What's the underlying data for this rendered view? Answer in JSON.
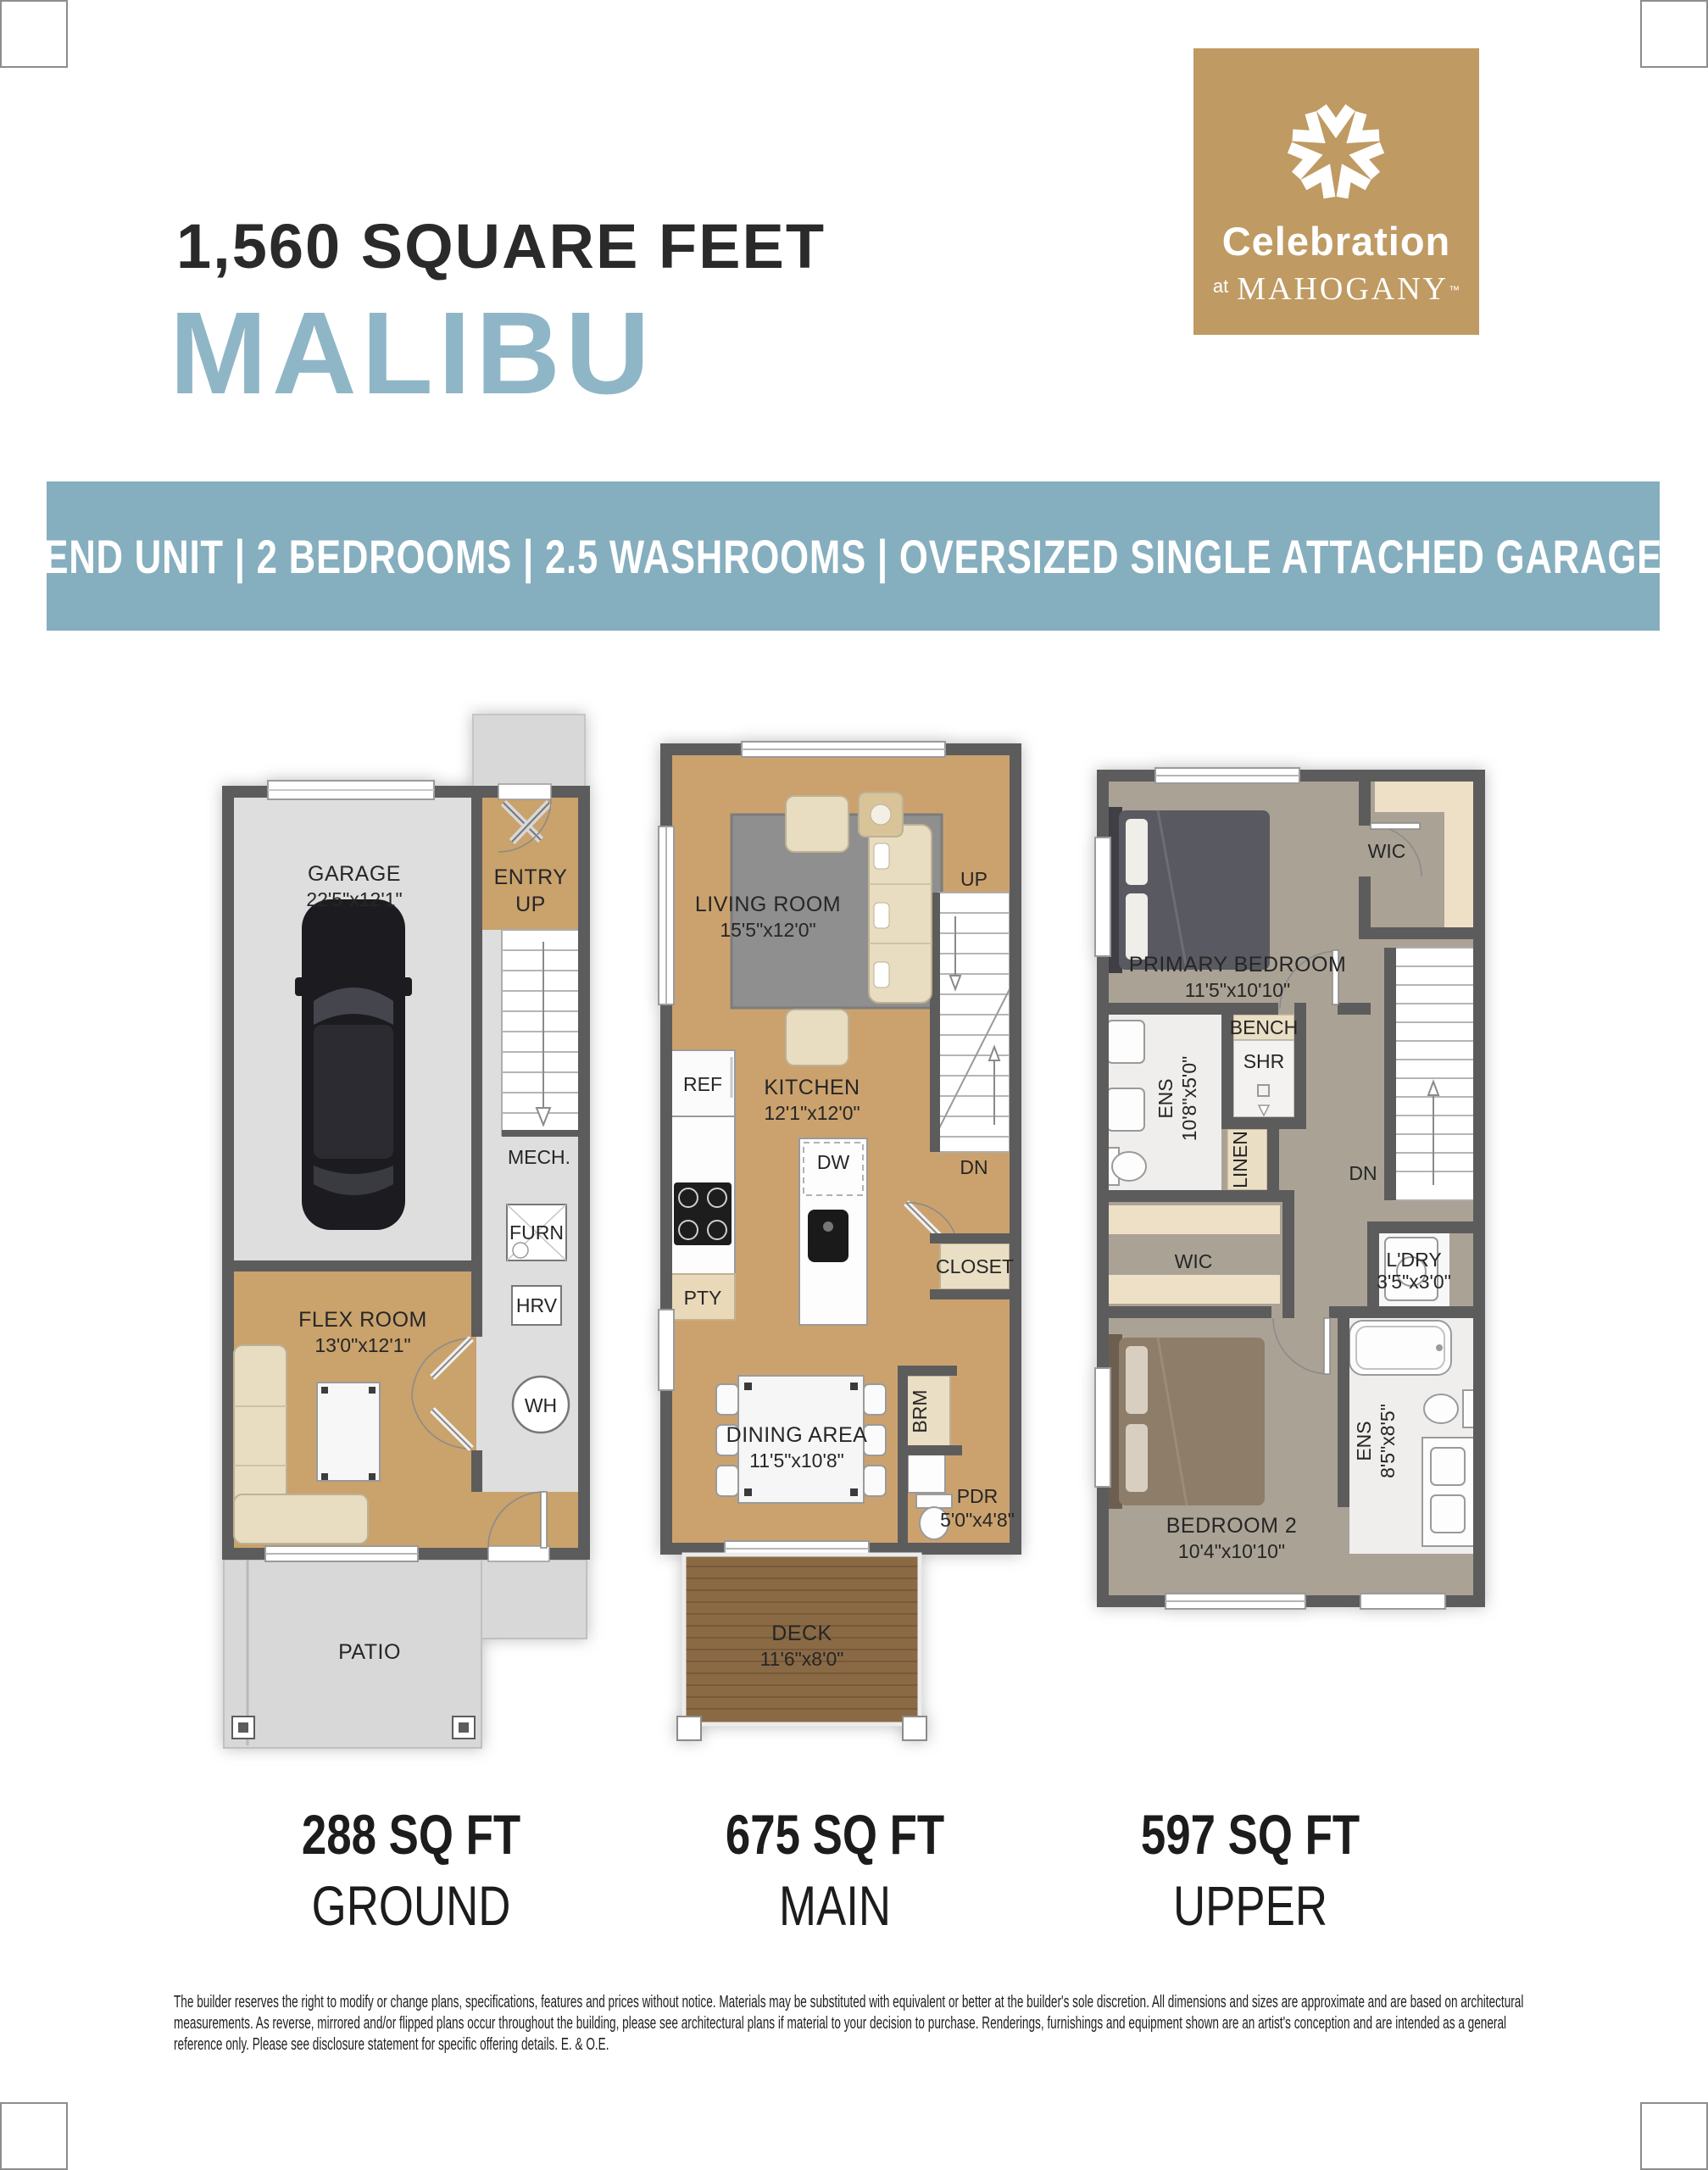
{
  "header": {
    "square_feet": "1,560 SQUARE FEET",
    "model_name": "MALIBU",
    "banner": "END UNIT | 2 BEDROOMS | 2.5 WASHROOMS | OVERSIZED SINGLE ATTACHED GARAGE"
  },
  "logo": {
    "brand": "Celebration",
    "at": "at",
    "community": "MAHOGANY",
    "tm": "™"
  },
  "floors": [
    {
      "area": "288 SQ FT",
      "name": "GROUND"
    },
    {
      "area": "675 SQ FT",
      "name": "MAIN"
    },
    {
      "area": "597 SQ FT",
      "name": "UPPER"
    }
  ],
  "plans": {
    "ground": {
      "garage": {
        "name": "GARAGE",
        "dims": "22'5\"x12'1\""
      },
      "entry": {
        "name": "ENTRY",
        "sub": "UP"
      },
      "mech": {
        "name": "MECH."
      },
      "furn": {
        "name": "FURN"
      },
      "hrv": {
        "name": "HRV"
      },
      "wh": {
        "name": "WH"
      },
      "flex": {
        "name": "FLEX ROOM",
        "dims": "13'0\"x12'1\""
      },
      "patio": {
        "name": "PATIO"
      }
    },
    "main": {
      "living": {
        "name": "LIVING ROOM",
        "dims": "15'5\"x12'0\""
      },
      "up": {
        "name": "UP"
      },
      "dn": {
        "name": "DN"
      },
      "kitchen": {
        "name": "KITCHEN",
        "dims": "12'1\"x12'0\""
      },
      "ref": {
        "name": "REF"
      },
      "dw": {
        "name": "DW"
      },
      "pty": {
        "name": "PTY"
      },
      "closet": {
        "name": "CLOSET"
      },
      "dining": {
        "name": "DINING AREA",
        "dims": "11'5\"x10'8\""
      },
      "brm": {
        "name": "BRM"
      },
      "pdr": {
        "name": "PDR",
        "dims": "5'0\"x4'8\""
      },
      "deck": {
        "name": "DECK",
        "dims": "11'6\"x8'0\""
      }
    },
    "upper": {
      "wic1": {
        "name": "WIC"
      },
      "primary": {
        "name": "PRIMARY BEDROOM",
        "dims": "11'5\"x10'10\""
      },
      "bench": {
        "name": "BENCH"
      },
      "shr": {
        "name": "SHR"
      },
      "ens1": {
        "name": "ENS",
        "dims": "10'8\"x5'0\""
      },
      "linen": {
        "name": "LINEN"
      },
      "dn": {
        "name": "DN"
      },
      "wic2": {
        "name": "WIC"
      },
      "ldry": {
        "name": "L'DRY",
        "dims": "3'5\"x3'0\""
      },
      "ens2": {
        "name": "ENS",
        "dims": "8'5\"x8'5\""
      },
      "bedroom2": {
        "name": "BEDROOM 2",
        "dims": "10'4\"x10'10\""
      }
    }
  },
  "footer": {
    "disclaimer": "The builder reserves the right to modify or change plans, specifications, features and prices without notice. Materials may be substituted with equivalent or better at the builder's sole discretion. All dimensions and sizes are approximate and are based on architectural measurements. As reverse, mirrored and/or flipped plans occur throughout the building, please see architectural plans if material to your decision to purchase. Renderings, furnishings and equipment shown are an artist's conception and are intended as a general reference only. Please see disclosure statement for specific offering details. E. & O.E."
  },
  "colors": {
    "logo_gold": "#BF9A62",
    "banner_blue": "#85AEBE",
    "model_blue": "#8FB6C6",
    "wall_gray": "#5D5C5C"
  }
}
